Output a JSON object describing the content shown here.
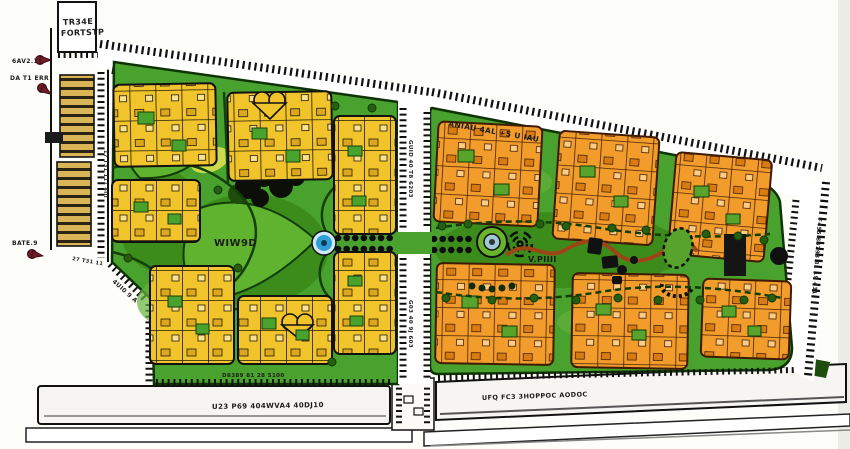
{
  "title": "residential-community-master-plan",
  "colors": {
    "field_green": "#4aa22e",
    "dark_green": "#3c8c1c",
    "leaf_green": "#5fb32e",
    "yellow_building": "#f2c42c",
    "orange_building": "#f29d2b",
    "carport_gold": "#d9b557",
    "marker_red": "#6e1d28",
    "fountain_blue": "#2f9fd6",
    "path_red": "#9e4518",
    "road_white": "#f6f5f1",
    "outline_black": "#111111"
  },
  "labels": {
    "corner_building": {
      "line1": "TR34E",
      "line2": "FORTSTP"
    },
    "markers": [
      {
        "text": "6AV2.1"
      },
      {
        "text": "DA T1 ERR"
      },
      {
        "text": "BATE.9"
      }
    ],
    "roads": {
      "top": "ANIAU 4AL +5 U IAU",
      "middle_upper": "GUID 40 T8 6203",
      "middle_lower": "G03 40 9J 603",
      "right": "F455 84793 81 19 431",
      "left_vertical": "17 T31 111 4III",
      "left_note": "27 T31 11",
      "left_diagonal": "4UI0 9 A",
      "boulevard_west": "U23 P69 404WVA4 40DJ10",
      "boulevard_east": "UFQ FC3 3HOPPOC AODOC",
      "south_note": "D8389 81 28 5100"
    },
    "parks": {
      "west": "WIW9D",
      "east": "V.PIIII"
    }
  }
}
